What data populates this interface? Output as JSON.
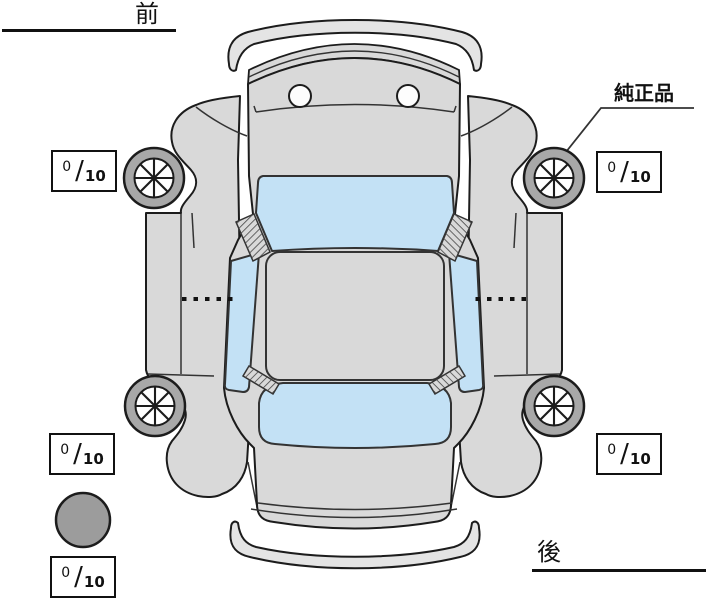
{
  "labels": {
    "front": "前",
    "rear": "後",
    "genuine_part": "純正品"
  },
  "scores": {
    "separator": "/",
    "front_left": {
      "value": "0",
      "max": "10"
    },
    "front_right": {
      "value": "0",
      "max": "10"
    },
    "rear_left": {
      "value": "0",
      "max": "10"
    },
    "rear_right": {
      "value": "0",
      "max": "10"
    },
    "spare": {
      "value": "0",
      "max": "10"
    }
  },
  "icons": {
    "car": "car-top-view-icon",
    "wheel": "wheel-spoke-icon",
    "spare": "spare-tire-icon"
  },
  "colors": {
    "body_gray": "#d9d9d9",
    "bumper_gray": "#e4e4e4",
    "glass_blue": "#c3e1f5",
    "wheel_ring_gray": "#a8a8a8",
    "spare_gray": "#9c9c9c",
    "outline": "#1c1c1c"
  }
}
